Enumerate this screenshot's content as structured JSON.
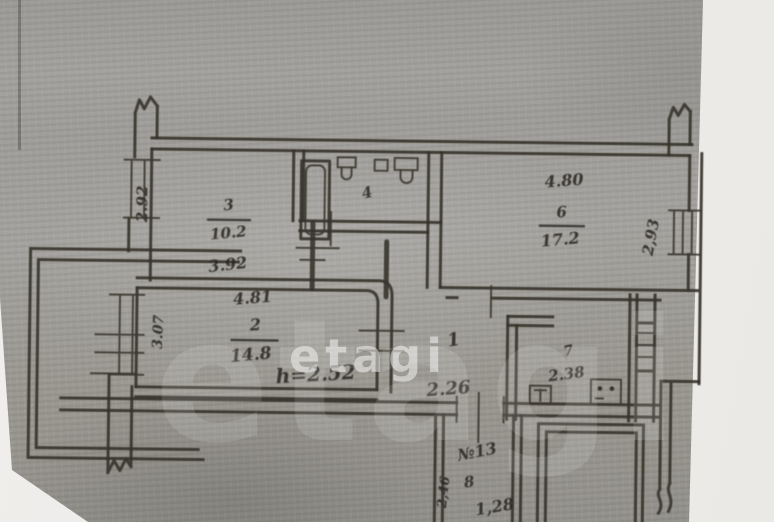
{
  "plan": {
    "watermark": {
      "brand": "etagi"
    },
    "balcony": {
      "depth": "3.07"
    },
    "rooms": {
      "room1": {
        "number": "1",
        "width": "2.26"
      },
      "room2": {
        "number": "2",
        "area": "14.8",
        "width": "4.81",
        "ceiling": "h=2.52"
      },
      "room3": {
        "number": "3",
        "area": "10.2",
        "width": "3.92",
        "depth": "2.92"
      },
      "room4": {
        "number": "4"
      },
      "room6": {
        "number": "6",
        "area": "17.2",
        "width": "4.80",
        "depth": "2,93"
      },
      "room7": {
        "number": "7",
        "area": "2.38"
      },
      "room8": {
        "number": "8",
        "apartment_no": "№13",
        "width": "1,28",
        "depth": "2,46"
      }
    }
  },
  "colors": {
    "paper_gray": "#a19f9b",
    "ink": "#34312b",
    "watermark_white": "#ffffff",
    "background_white": "#efedeb"
  }
}
